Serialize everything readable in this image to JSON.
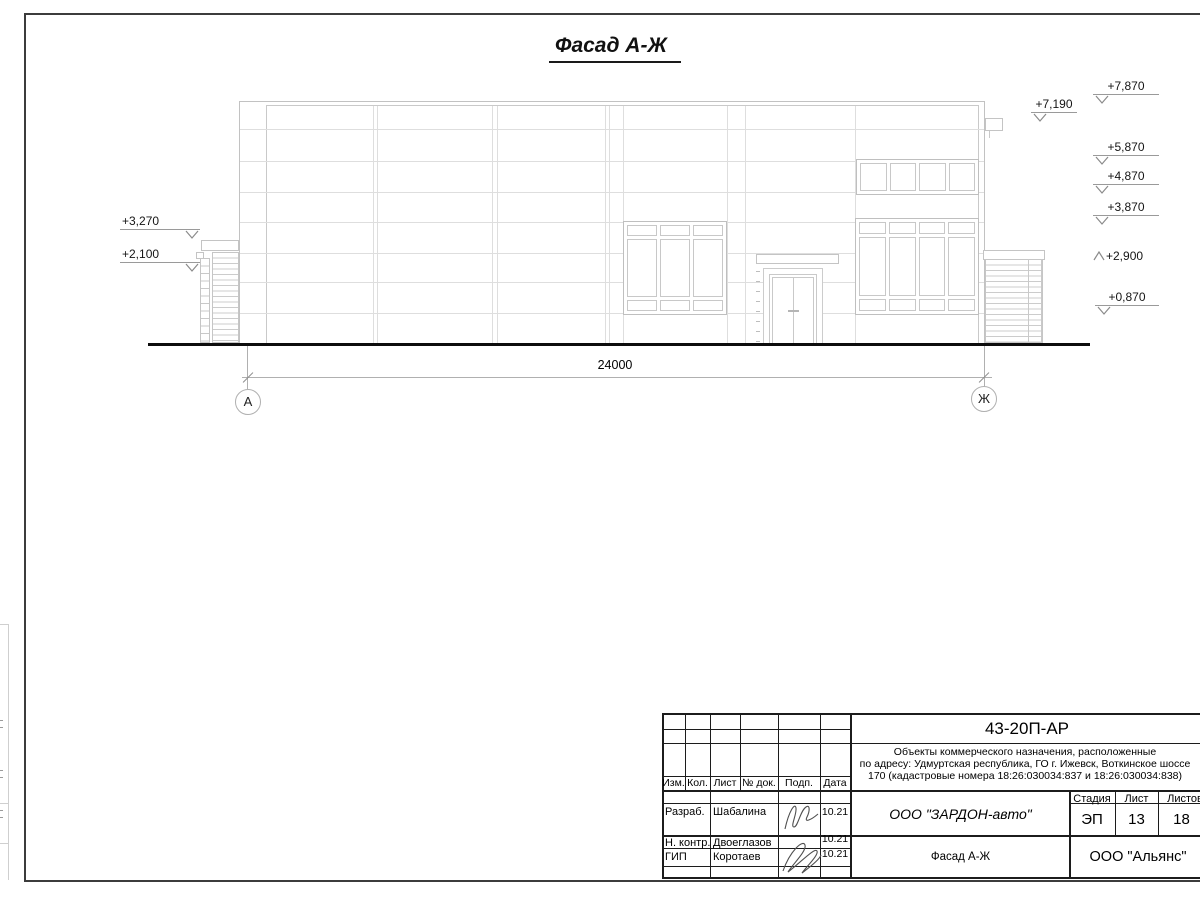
{
  "drawing": {
    "title": "Фасад А-Ж",
    "dimension_total": "24000",
    "axis_left": "А",
    "axis_right": "Ж",
    "elevations_right": [
      {
        "label": "+7,870"
      },
      {
        "label": "+7,190"
      },
      {
        "label": "+5,870"
      },
      {
        "label": "+4,870"
      },
      {
        "label": "+3,870"
      },
      {
        "label": "+2,900"
      },
      {
        "label": "+0,870"
      }
    ],
    "elevations_left": [
      {
        "label": "+3,270"
      },
      {
        "label": "+2,100"
      }
    ]
  },
  "title_block": {
    "doc_number": "43-20П-АР",
    "project_description": {
      "line1": "Объекты коммерческого назначения, расположенные",
      "line2": "по адресу: Удмуртская республика, ГО г. Ижевск, Воткинское шоссе",
      "line3": "170 (кадастровые номера 18:26:030034:837 и 18:26:030034:838)"
    },
    "header_cols": {
      "izm": "Изм.",
      "kol": "Кол.",
      "list": "Лист",
      "ndok": "№ док.",
      "podp": "Подп.",
      "data": "Дата"
    },
    "signature_rows": [
      {
        "role": "Разраб.",
        "name": "Шабалина",
        "date": "10.21"
      },
      {
        "role": "Н. контр.",
        "name": "Двоеглазов",
        "date": "10.21"
      },
      {
        "role": "ГИП",
        "name": "Коротаев",
        "date": "10.21"
      }
    ],
    "client_org": "ООО \"ЗАРДОН-авто\"",
    "stage_label": "Стадия",
    "stage_value": "ЭП",
    "sheet_label": "Лист",
    "sheet_value": "13",
    "sheets_label": "Листов",
    "sheets_value": "18",
    "sheet_name": "Фасад А-Ж",
    "org": "ООО \"Альянс\""
  }
}
